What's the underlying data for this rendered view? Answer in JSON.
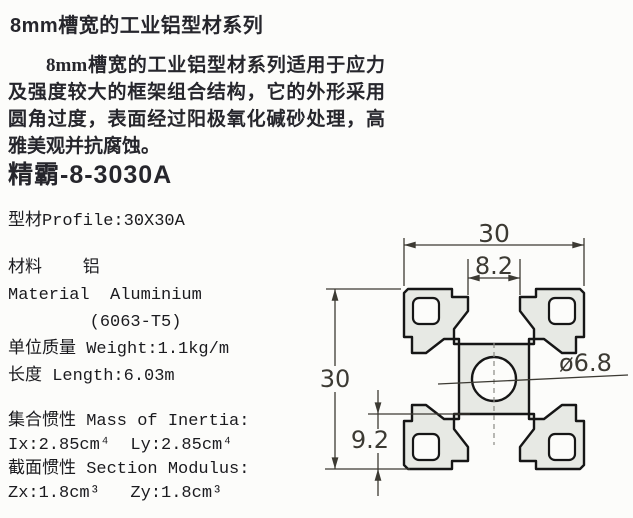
{
  "header": {
    "title": "8mm槽宽的工业铝型材系列"
  },
  "intro": {
    "text": "8mm槽宽的工业铝型材系列适用于应力及强度较大的框架组合结构，它的外形采用圆角过度，表面经过阳极氧化碱砂处理，高雅美观并抗腐蚀。"
  },
  "product": {
    "model": "精霸-8-3030A"
  },
  "specs": {
    "profile": "型材Profile:30X30A",
    "material_cn": "材料    铝",
    "material_en": "Material  Aluminium",
    "material_grade": "        (6063-T5)",
    "weight": "单位质量 Weight:1.1kg/m",
    "length": "长度 Length:6.03m",
    "inertia_title": "集合惯性 Mass of Inertia:",
    "inertia_values": "Ix:2.85cm⁴  Ly:2.85cm⁴",
    "modulus_title": "截面惯性 Section Modulus:",
    "modulus_values": "Zx:1.8cm³   Zy:1.8cm³"
  },
  "drawing": {
    "dim_width": "30",
    "dim_slot": "8.2",
    "dim_height": "30",
    "dim_offset": "9.2",
    "dim_hole": "ø6.8",
    "fill": "#e7e9e4",
    "outline_color": "#161616",
    "dim_color": "#3c3a33",
    "background": "#fcfcfa"
  }
}
